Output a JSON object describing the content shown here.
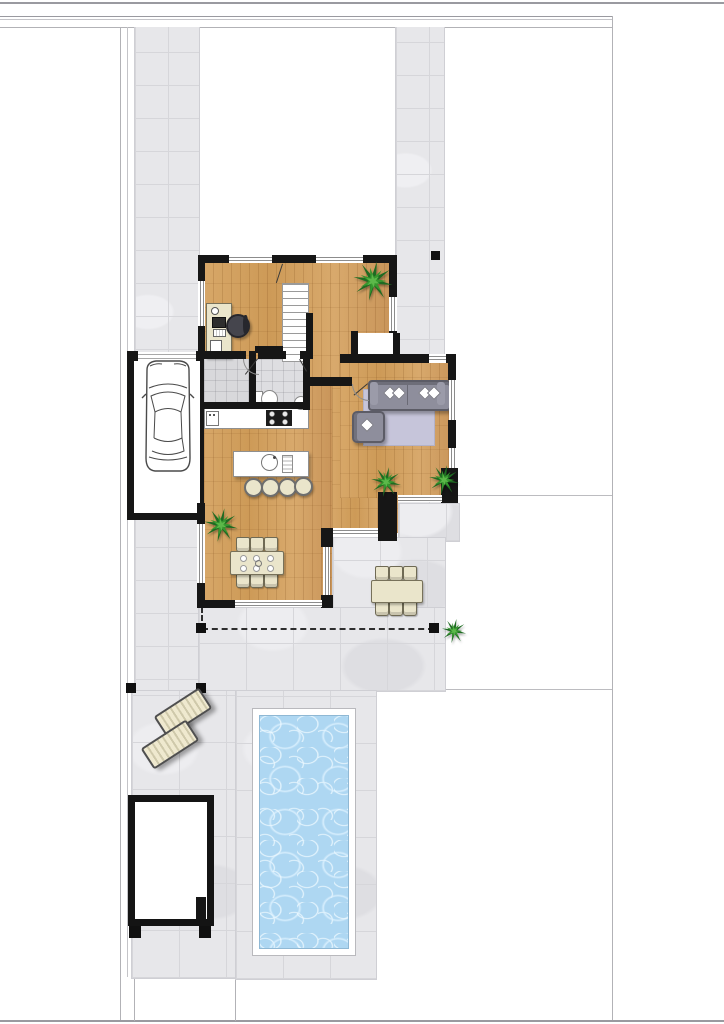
{
  "meta": {
    "type": "architectural-floor-plan",
    "view": "top-down ground-floor site plan with garden and pool",
    "visible_text": "none"
  },
  "palette": {
    "wall": "#161616",
    "wood_floor": "#d2a162",
    "paving": "#e7e7ea",
    "paving_line": "#d6d6da",
    "pool_water": "#aed7f2",
    "pool_rim": "#ffffff",
    "rug": "#c6c5da",
    "sofa": "#8e8e9c",
    "cream": "#eae5cb",
    "plant_dark": "#1e6b22",
    "plant_mid": "#36972e",
    "plant_light": "#5cb84a",
    "lawn": "#ffffff"
  },
  "zones": {
    "garage": {
      "cars": 1,
      "door": "sectional front door"
    },
    "entrance_hall": {
      "floor": "grey tile"
    },
    "bathroom": {
      "fixtures": [
        "toilet",
        "washbasin"
      ]
    },
    "office": {
      "furniture": [
        "desk",
        "office-chair"
      ]
    },
    "staircase": {
      "treads": 11
    },
    "kitchen": {
      "furniture": [
        "wall-counter-with-sink",
        "cooktop-4-burners",
        "island-with-prep-sink",
        "bar-stools"
      ],
      "bar_stool_count": 4
    },
    "living_room": {
      "furniture": [
        "sofa",
        "armchair",
        "rug"
      ],
      "sofa_cushions": 4
    },
    "dining_room": {
      "table": 1,
      "chairs": 6
    },
    "terrace": {
      "outdoor_table": 1,
      "outdoor_chairs": 6,
      "pergola_posts": 4,
      "boundary": "dashed line"
    },
    "pool_garden": {
      "pool": 1,
      "sun_loungers": 2,
      "shed": 1
    },
    "plants_total": 5
  }
}
